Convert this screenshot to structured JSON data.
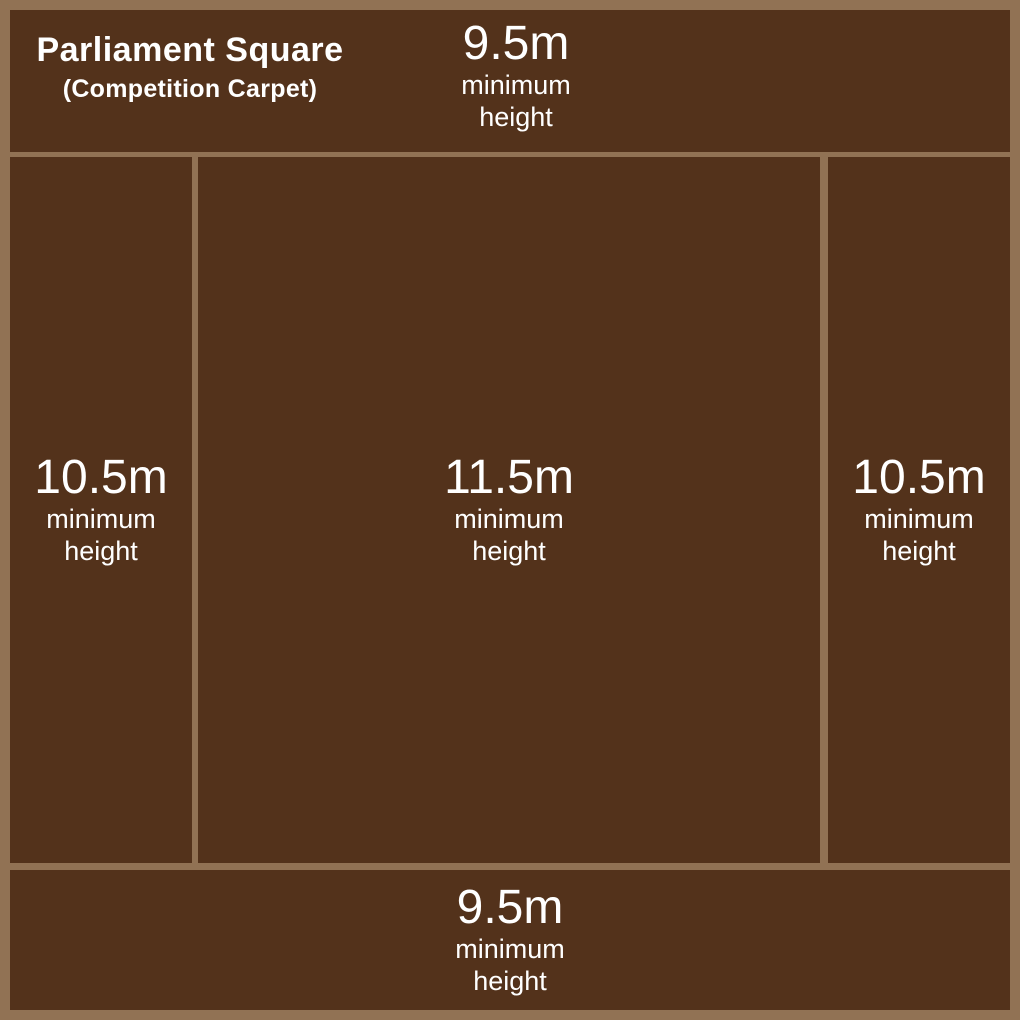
{
  "title": {
    "line1": "Parliament Square",
    "line2": "(Competition Carpet)"
  },
  "zones": {
    "top": {
      "value": "9.5m",
      "label_line1": "minimum",
      "label_line2": "height"
    },
    "left": {
      "value": "10.5m",
      "label_line1": "minimum",
      "label_line2": "height"
    },
    "center": {
      "value": "11.5m",
      "label_line1": "minimum",
      "label_line2": "height"
    },
    "right": {
      "value": "10.5m",
      "label_line1": "minimum",
      "label_line2": "height"
    },
    "bottom": {
      "value": "9.5m",
      "label_line1": "minimum",
      "label_line2": "height"
    }
  },
  "colors": {
    "background": "#917254",
    "zone": "#53321B",
    "text": "#FFFFFF"
  }
}
